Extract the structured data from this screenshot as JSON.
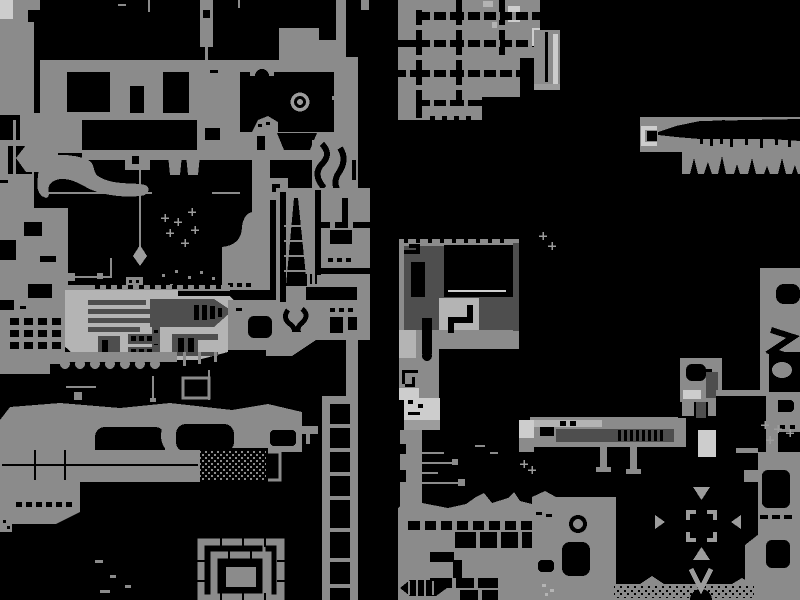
{
  "app": {
    "name": "game-world-map-screen",
    "visible_text": ""
  },
  "canvas": {
    "width": 800,
    "height": 600
  },
  "colors": {
    "black": "#000000",
    "base": "#8b8b8b",
    "mid": "#9c9c9c",
    "light": "#b4b4b4",
    "lighter": "#cdcdcd",
    "dark": "#4e4e4e"
  },
  "features": [
    "left-landmass",
    "ring-landmark",
    "ship-structure",
    "plumb-line-marker",
    "spiral-rooms",
    "black-spire",
    "elevator-shaft",
    "top-middle-room-grid",
    "middle-vault-structure",
    "small-tower",
    "right-cavern-band",
    "right-column-rooms",
    "conveyor-structure",
    "black-vault-room",
    "bottom-room-grid",
    "compass-arrows",
    "targeting-reticle",
    "v-gate-marker",
    "stipple-rubble",
    "connector-ticks"
  ]
}
